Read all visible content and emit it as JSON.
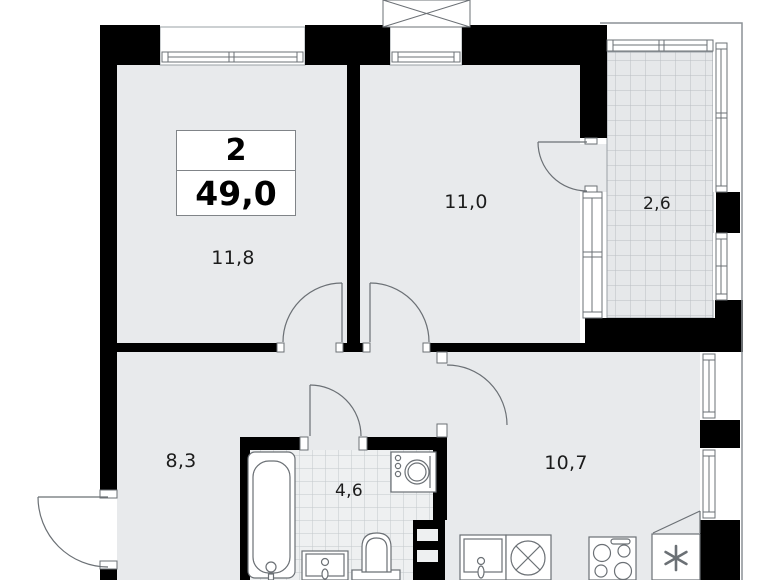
{
  "unit_info_box": {
    "rooms_count": "2",
    "total_area": "49,0"
  },
  "room_labels": {
    "living": "11,8",
    "bedroom": "11,0",
    "balcony": "2,6",
    "hallway": "8,3",
    "bathroom": "4,6",
    "kitchen": "10,7"
  },
  "fixtures": [
    "bathtub",
    "bathroom-sink",
    "toilet",
    "washing-machine",
    "vent-shaft",
    "kitchen-cabinet",
    "kitchen-sink",
    "stove",
    "fridge"
  ],
  "colors": {
    "wall": "#000000",
    "floor": "#e8eaec",
    "tile_line": "#bcc1c6",
    "outline": "#6b7075",
    "label_text": "#1c1c1c",
    "background": "#ffffff"
  }
}
